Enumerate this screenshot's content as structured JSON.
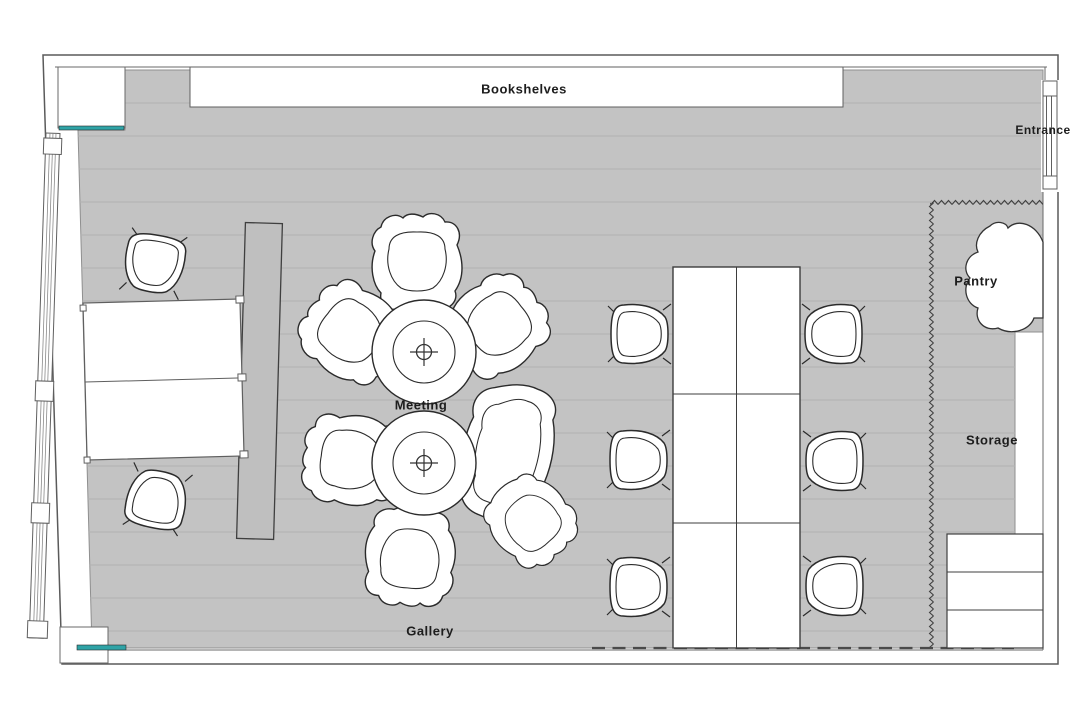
{
  "plan": {
    "labels": {
      "bookshelves": "Bookshelves",
      "entrance": "Entrance",
      "pantry": "Pantry",
      "storage": "Storage",
      "meeting": "Meeting",
      "gallery": "Gallery"
    },
    "colors": {
      "background": "#ffffff",
      "floor": "#c3c3c3",
      "plank_line": "#b2b2b2",
      "wall_outline": "#5a5a5a",
      "furniture_outline": "#2b2b2b",
      "partition_fill": "#bfbfbf",
      "accent_teal": "#2fa3a6"
    },
    "furniture_counts": {
      "meeting_round_tables": 2,
      "meeting_lounge_chairs": 7,
      "work_table_chairs": 6,
      "desk_chairs": 2,
      "work_table_rows": 3,
      "work_table_columns": 2,
      "storage_shelf_rows": 3
    }
  }
}
